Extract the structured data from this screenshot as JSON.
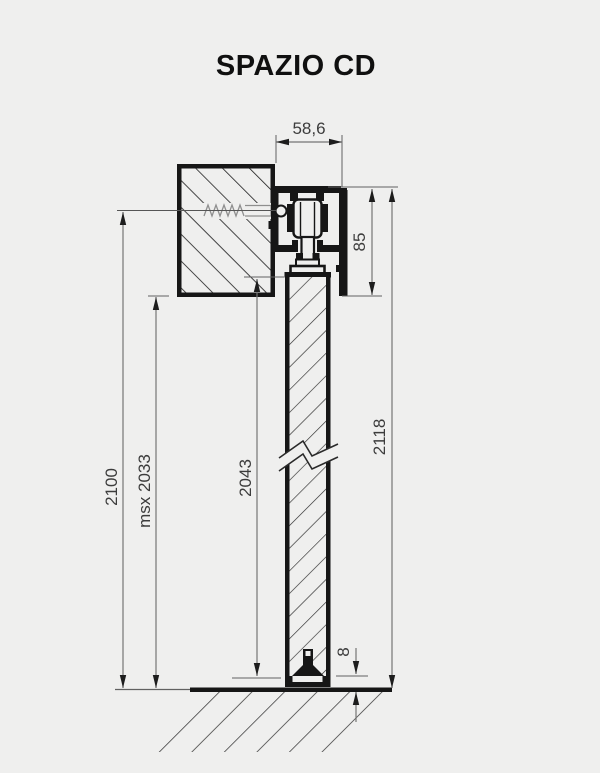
{
  "title": "SPAZIO CD",
  "colors": {
    "background": "#efefee",
    "drawing_line": "#161616",
    "dimension_line": "#757575",
    "dimension_text": "#3c3c3c",
    "hatch": "#2a2a2a"
  },
  "dims": {
    "track_depth": "58,6",
    "track_height": "85",
    "total_height": "2118",
    "door_height": "2043",
    "opening_height": "2100",
    "max_height": "msx 2033",
    "floor_gap": "8"
  },
  "parts": {
    "wall_section": "hatched wall section with anchor screw",
    "track": "ceiling-fixed sliding track with roller carriage",
    "door": "sliding door leaf (broken view)",
    "floor": "floor line with hatching"
  }
}
